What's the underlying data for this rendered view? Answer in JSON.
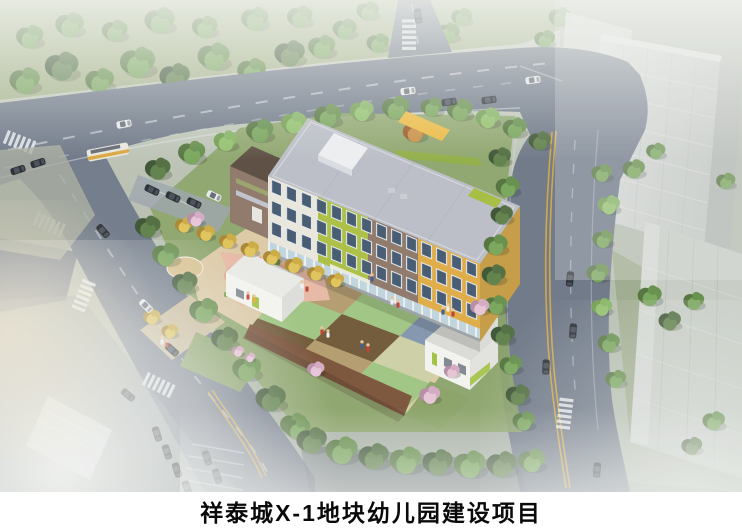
{
  "caption": {
    "title": "祥泰城X-1地块幼儿园建设项目"
  },
  "scene": {
    "description": "Aerial architectural rendering of a kindergarten campus: a four-color facade building (white, lime, taupe, yellow), checkered play field, pink playground with play equipment, white service buildings, perimeter trees, surrounding roads with cars and a bus, and hazy residential towers at the upper right."
  },
  "palette": {
    "caption_bg": "#ffffff",
    "caption_text": "#0a0a0a",
    "facade_white": "#e9e6da",
    "facade_lime": "#a9bf3e",
    "facade_taupe": "#8b7464",
    "facade_yellow": "#dfab41",
    "facade_yellow_side": "#c49a3f",
    "roof": "#b9bdc5",
    "accent_yellow": "#ecb93c",
    "window": "#3f566e",
    "road": "#6a7484",
    "lane_yellow": "#d9aa3c",
    "lawn": "#87a163",
    "plaza": "#dcc9a4",
    "playground_pink": "#e7b7a4",
    "track": "#764b33",
    "checker_tan": "#b2996a",
    "checker_sage": "#cdd0a4",
    "checker_green": "#9dc47f",
    "checker_blue": "#7f93ad",
    "checker_brown": "#8a6f4b",
    "checker_darkbrown": "#6d5432",
    "checker_lavender": "#ab9ac2",
    "checker_cream": "#d6cda0"
  }
}
